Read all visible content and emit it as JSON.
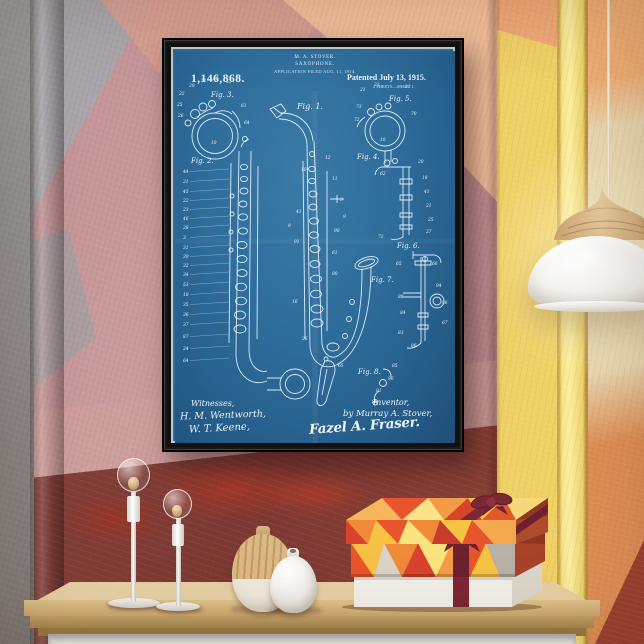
{
  "poster": {
    "patent_number": "1,146,868.",
    "inventor_abbrev": "M. A. STOVER.",
    "title": "SAXOPHONE.",
    "application_line": "APPLICATION FILED AUG. 11, 1914.",
    "patented_line": "Patented July 13, 1915.",
    "sheet_line": "2 SHEETS—SHEET 1.",
    "figure_labels": {
      "fig1": "Fig. 1.",
      "fig2": "Fig. 2.",
      "fig3": "Fig. 3.",
      "fig4": "Fig. 4.",
      "fig5": "Fig. 5.",
      "fig6": "Fig. 6.",
      "fig7": "Fig. 7.",
      "fig8": "Fig. 8."
    },
    "witnesses_label": "Witnesses,",
    "witness_signatures": [
      "H. M. Wentworth,",
      "W. T. Keene,"
    ],
    "inventor_label": "Inventor,",
    "inventor_by_line": "by Murray A. Stover,",
    "attorney_signature": "Fazel A. Fraser.",
    "ref_numbers": [
      {
        "t": "22",
        "x": 4,
        "y": 44
      },
      {
        "t": "20",
        "x": 14,
        "y": 36
      },
      {
        "t": "51",
        "x": 26,
        "y": 31
      },
      {
        "t": "52",
        "x": 38,
        "y": 29
      },
      {
        "t": "53",
        "x": 51,
        "y": 32
      },
      {
        "t": "61",
        "x": 66,
        "y": 56
      },
      {
        "t": "64",
        "x": 69,
        "y": 73
      },
      {
        "t": "10",
        "x": 36,
        "y": 93
      },
      {
        "t": "25",
        "x": 2,
        "y": 55
      },
      {
        "t": "26",
        "x": 3,
        "y": 66
      },
      {
        "t": "21",
        "x": 185,
        "y": 40
      },
      {
        "t": "23",
        "x": 199,
        "y": 35
      },
      {
        "t": "31",
        "x": 230,
        "y": 37
      },
      {
        "t": "73",
        "x": 181,
        "y": 57
      },
      {
        "t": "72",
        "x": 179,
        "y": 70
      },
      {
        "t": "70",
        "x": 236,
        "y": 64
      },
      {
        "t": "10",
        "x": 205,
        "y": 90
      },
      {
        "t": "12",
        "x": 150,
        "y": 108
      },
      {
        "t": "10",
        "x": 126,
        "y": 120
      },
      {
        "t": "11",
        "x": 157,
        "y": 129
      },
      {
        "t": "3",
        "x": 165,
        "y": 150
      },
      {
        "t": "41",
        "x": 121,
        "y": 162
      },
      {
        "t": "8",
        "x": 113,
        "y": 176
      },
      {
        "t": "91",
        "x": 119,
        "y": 192
      },
      {
        "t": "90",
        "x": 159,
        "y": 181
      },
      {
        "t": "61",
        "x": 157,
        "y": 203
      },
      {
        "t": "80",
        "x": 157,
        "y": 224
      },
      {
        "t": "16",
        "x": 117,
        "y": 252
      },
      {
        "t": "26",
        "x": 127,
        "y": 289
      },
      {
        "t": "9",
        "x": 168,
        "y": 167
      },
      {
        "t": "44",
        "x": 8,
        "y": 122,
        "lx": 54,
        "ly": 118
      },
      {
        "t": "21",
        "x": 8,
        "y": 132,
        "lx": 54,
        "ly": 128
      },
      {
        "t": "45",
        "x": 8,
        "y": 142,
        "lx": 54,
        "ly": 138
      },
      {
        "t": "22",
        "x": 8,
        "y": 151,
        "lx": 54,
        "ly": 147
      },
      {
        "t": "23",
        "x": 8,
        "y": 160,
        "lx": 54,
        "ly": 156
      },
      {
        "t": "46",
        "x": 8,
        "y": 169,
        "lx": 54,
        "ly": 165
      },
      {
        "t": "28",
        "x": 8,
        "y": 178,
        "lx": 54,
        "ly": 174
      },
      {
        "t": "3",
        "x": 8,
        "y": 188,
        "lx": 54,
        "ly": 184
      },
      {
        "t": "31",
        "x": 8,
        "y": 198,
        "lx": 54,
        "ly": 194
      },
      {
        "t": "30",
        "x": 8,
        "y": 207,
        "lx": 54,
        "ly": 203
      },
      {
        "t": "32",
        "x": 8,
        "y": 216,
        "lx": 54,
        "ly": 212
      },
      {
        "t": "34",
        "x": 8,
        "y": 225,
        "lx": 54,
        "ly": 221
      },
      {
        "t": "53",
        "x": 8,
        "y": 235,
        "lx": 54,
        "ly": 231
      },
      {
        "t": "18",
        "x": 8,
        "y": 245,
        "lx": 54,
        "ly": 241
      },
      {
        "t": "35",
        "x": 8,
        "y": 255,
        "lx": 54,
        "ly": 251
      },
      {
        "t": "36",
        "x": 8,
        "y": 265,
        "lx": 54,
        "ly": 261
      },
      {
        "t": "37",
        "x": 8,
        "y": 275,
        "lx": 54,
        "ly": 271
      },
      {
        "t": "87",
        "x": 8,
        "y": 287,
        "lx": 54,
        "ly": 283
      },
      {
        "t": "24",
        "x": 8,
        "y": 299,
        "lx": 54,
        "ly": 295
      },
      {
        "t": "64",
        "x": 8,
        "y": 311,
        "lx": 54,
        "ly": 307
      },
      {
        "t": "20",
        "x": 243,
        "y": 112
      },
      {
        "t": "62",
        "x": 205,
        "y": 124
      },
      {
        "t": "18",
        "x": 247,
        "y": 128
      },
      {
        "t": "41",
        "x": 249,
        "y": 142
      },
      {
        "t": "21",
        "x": 251,
        "y": 156
      },
      {
        "t": "25",
        "x": 253,
        "y": 170
      },
      {
        "t": "27",
        "x": 251,
        "y": 182
      },
      {
        "t": "72",
        "x": 203,
        "y": 187
      },
      {
        "t": "65",
        "x": 221,
        "y": 214
      },
      {
        "t": "66",
        "x": 257,
        "y": 214
      },
      {
        "t": "88",
        "x": 223,
        "y": 247
      },
      {
        "t": "94",
        "x": 261,
        "y": 236
      },
      {
        "t": "96",
        "x": 267,
        "y": 253
      },
      {
        "t": "84",
        "x": 225,
        "y": 263
      },
      {
        "t": "67",
        "x": 267,
        "y": 273
      },
      {
        "t": "83",
        "x": 223,
        "y": 283
      },
      {
        "t": "86",
        "x": 236,
        "y": 296
      },
      {
        "t": "85",
        "x": 217,
        "y": 316
      },
      {
        "t": "86",
        "x": 213,
        "y": 329
      },
      {
        "t": "81",
        "x": 201,
        "y": 341
      },
      {
        "t": "82",
        "x": 197,
        "y": 352
      },
      {
        "t": "65",
        "x": 163,
        "y": 316
      }
    ]
  },
  "colors": {
    "blueprint_blue": "#2e6c9b",
    "blueprint_line": "#ecf4fa",
    "frame_black": "#101010",
    "wall_pink": "#c5999c",
    "wall_maroon": "#7e3a33",
    "wall_yellow": "#f0d166",
    "wall_orange": "#efa06c",
    "table_wood": "#ddc093",
    "ribbon_maroon": "#7c2736",
    "lamp_white": "#f4f2ee"
  }
}
